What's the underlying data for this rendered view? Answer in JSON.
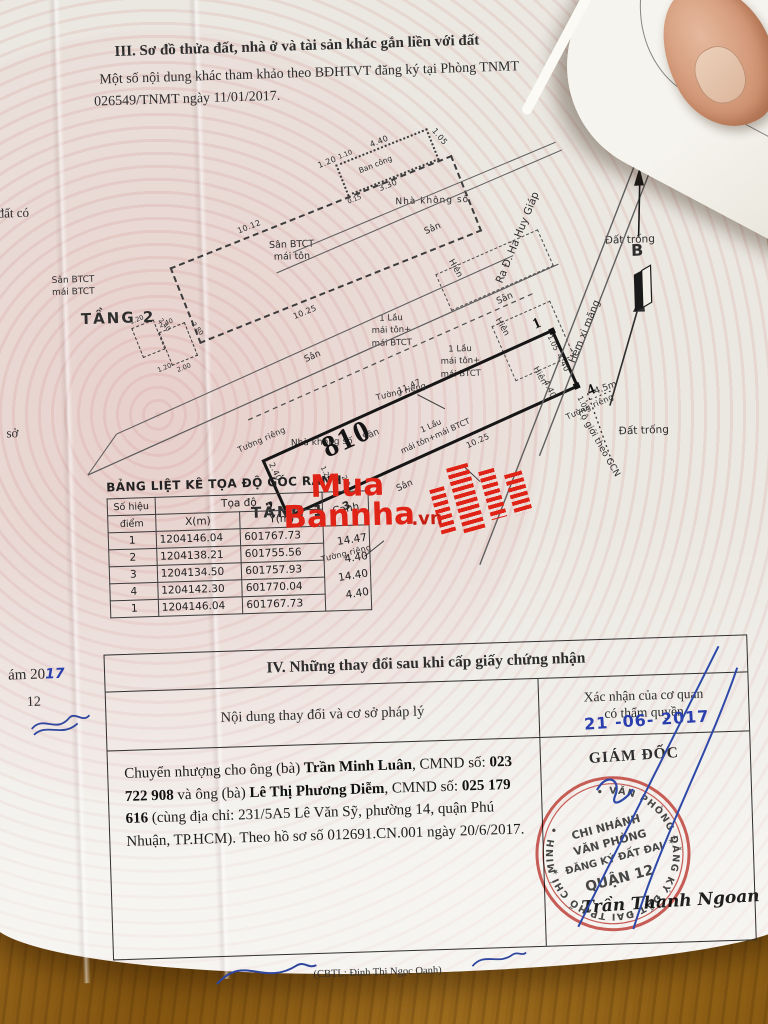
{
  "section3": {
    "heading": "III. Sơ đồ thửa đất, nhà ở và tài sản khác gắn liền với đất",
    "note1": "Một số nội dung khác tham khảo theo BĐHTVT đăng ký tại Phòng TNMT",
    "note2": "026549/TNMT ngày 11/01/2017."
  },
  "diagram": {
    "north_label": "B",
    "floor2": {
      "label": "TẦNG 2",
      "inner1": "Sân BTCT",
      "inner2": "mái tôn",
      "balcony": "Ban công",
      "side1": "Sân BTCT",
      "side2": "mái BTCT",
      "dim_top": "10.12",
      "dim_bottom": "10.25",
      "bc_top": "4.40",
      "bc_mid": "3.30",
      "bc_right": "1.05",
      "bc_left": "1.20",
      "bc_small1": "0.15",
      "bc_small2": "1.10",
      "cl_1": "1.20",
      "cl_2": "2.40",
      "cl_3": "2.40",
      "cl_4": "2.80",
      "cl_5": "2.00",
      "cl_6": "1.20"
    },
    "floor1": {
      "label": "TẦNG 1",
      "parcel_no": "810",
      "parcel_l1": "1 Lầu",
      "parcel_l2": "mái tôn+mái BTCT",
      "house_l1": "1 Lầu",
      "house_l2": "mái tôn+",
      "house_l3": "mái BTCT",
      "c1": "1",
      "c2": "2",
      "c3": "3",
      "c4": "4",
      "dim_top": "11.47",
      "dim_bottom": "10.25",
      "dim_left": "2.40",
      "dim_l120": "1.20",
      "dim_l20": "2.0",
      "dim_r105a": "1.05",
      "dim_r440a": "4.40",
      "dim_r440b": "4.40",
      "dim_r105b": "1.05",
      "san": "Sân",
      "hien": "Hiên",
      "tuong_rieng": "Tường riêng",
      "nha_khong_so": "Nhà không số"
    },
    "env": {
      "ra_duong": "Ra Đ. Hà Huy Giáp",
      "hem": "Hẻm xi măng",
      "dat_trong": "Đất trống",
      "lo_gioi": "Lộ giới theo GCN",
      "lo_gioi_dim": "4.5m"
    }
  },
  "watermark": {
    "w1": "Mua",
    "w2": "Bannha",
    "w3": ".vn"
  },
  "coord_table": {
    "title": "BẢNG LIỆT KÊ TỌA ĐỘ GÓC RANH",
    "h_point1": "Số hiệu",
    "h_point2": "điểm",
    "h_coord": "Tọa độ",
    "h_x": "X(m)",
    "h_y": "Y(m)",
    "h_edge": "Cạnh",
    "rows": [
      {
        "p": "1",
        "x": "1204146.04",
        "y": "601767.73"
      },
      {
        "p": "2",
        "x": "1204138.21",
        "y": "601755.56"
      },
      {
        "p": "3",
        "x": "1204134.50",
        "y": "601757.93"
      },
      {
        "p": "4",
        "x": "1204142.30",
        "y": "601770.04"
      },
      {
        "p": "1",
        "x": "1204146.04",
        "y": "601767.73"
      }
    ],
    "edges": [
      "14.47",
      "4.40",
      "14.40",
      "4.40"
    ]
  },
  "section4": {
    "title": "IV. Những thay đổi sau khi cấp giấy chứng nhận",
    "col_left": "Nội dung thay đổi và cơ sở pháp lý",
    "col_right1": "Xác nhận của cơ quan",
    "col_right2": "có thẩm quyền",
    "date_stamp": "21 -06- 2017",
    "director": "GIÁM ĐỐC",
    "segments": [
      {
        "t": "Chuyển nhượng cho ông (bà) "
      },
      {
        "t": "Trần Minh Luân"
      },
      {
        "t": ", CMND số: "
      },
      {
        "t": "023 722 908"
      },
      {
        "t": " và ông (bà) "
      },
      {
        "t": "Lê Thị Phương Diễm"
      },
      {
        "t": ", CMND số: "
      },
      {
        "t": "025 179 616"
      },
      {
        "t": " (cùng địa chỉ: 231/5A5 Lê Văn Sỹ, phường 14, quận Phú Nhuận, TP.HCM)."
      },
      {
        "t": " Theo hồ sơ số 012691.CN.001 ngày 20/6/2017."
      }
    ],
    "clerk": "(CBTL: Đinh Thị Ngọc Oanh)",
    "signature": "Trần Thanh Ngoan",
    "stamp": {
      "ring": "• VĂN PHÒNG ĐĂNG KÝ ĐẤT ĐAI TP.HỒ CHÍ MINH •",
      "l1": "CHI NHÁNH",
      "l2": "VĂN PHÒNG",
      "l3": "ĐĂNG KÝ ĐẤT ĐAI",
      "l4": "QUẬN 12",
      "star": "✶"
    }
  },
  "edge_texts": {
    "e1": "đất có",
    "e2": "sở",
    "e3": "ám 20",
    "e3h": "17",
    "e4": "12",
    "fold1": "Nội dung thay",
    "fold2": "thế chấp b"
  }
}
